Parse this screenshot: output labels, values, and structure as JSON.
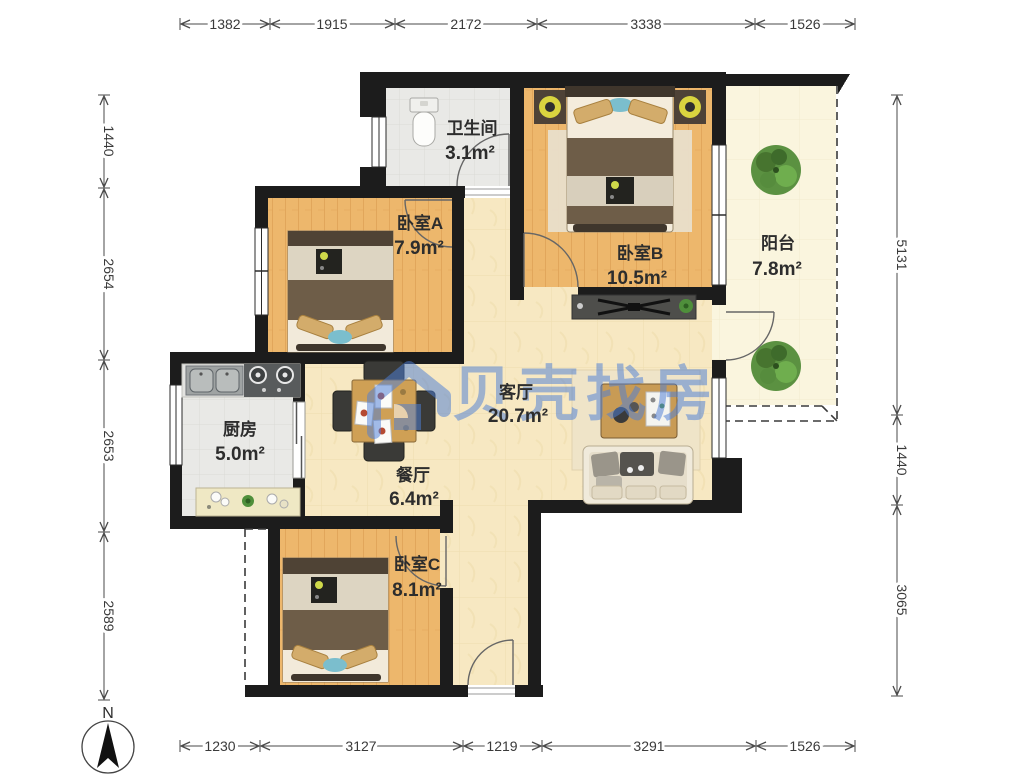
{
  "watermark": {
    "brand": "贝壳找房",
    "color": "#4E7FD6"
  },
  "compass": {
    "label": "N"
  },
  "rooms": [
    {
      "id": "bathroom",
      "name": "卫生间",
      "area": "3.1m²"
    },
    {
      "id": "bedroom-a",
      "name": "卧室A",
      "area": "7.9m²"
    },
    {
      "id": "bedroom-b",
      "name": "卧室B",
      "area": "10.5m²"
    },
    {
      "id": "balcony",
      "name": "阳台",
      "area": "7.8m²"
    },
    {
      "id": "kitchen",
      "name": "厨房",
      "area": "5.0m²"
    },
    {
      "id": "dining",
      "name": "餐厅",
      "area": "6.4m²"
    },
    {
      "id": "living",
      "name": "客厅",
      "area": "20.7m²"
    },
    {
      "id": "bedroom-c",
      "name": "卧室C",
      "area": "8.1m²"
    }
  ],
  "dimensions": {
    "top": [
      "1382",
      "1915",
      "2172",
      "3338",
      "1526"
    ],
    "bottom": [
      "1230",
      "3127",
      "1219",
      "3291",
      "1526"
    ],
    "left": [
      "1440",
      "2654",
      "2653",
      "2589"
    ],
    "right": [
      "5131",
      "1440",
      "3065"
    ]
  },
  "colors": {
    "wall": "#1c1c1c",
    "wood_floor": "#EDB76C",
    "marble_floor": "#F7E8C2",
    "tile_floor": "#E9E9E6",
    "balcony_floor": "#FAF5DE",
    "watermark_blue": "#4E7FD6",
    "dimension_text": "#3a3a3a"
  }
}
